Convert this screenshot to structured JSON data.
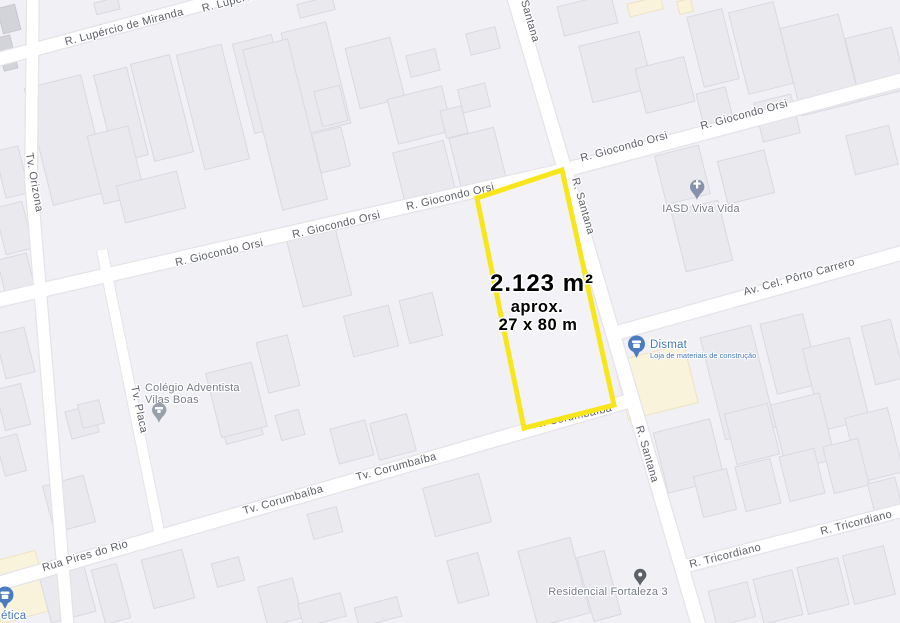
{
  "colors": {
    "background": "#f1f0f5",
    "building": "#e9e9ee",
    "building_dark": "#d3d4d9",
    "building_commercial": "#faf3dc",
    "road_fill": "#ffffff",
    "road_casing": "#e5e3e9",
    "road_label": "#5d6067",
    "poi_label_gray": "#787d87",
    "poi_label_blue": "#4578ba",
    "pin_church": "#8691ad",
    "pin_school": "#98a0ab",
    "pin_residential": "#5d6269",
    "pin_store_blue": "#4a7dc0",
    "parcel_outline": "#f7e61c",
    "parcel_text": "#000000"
  },
  "parcel": {
    "area": "2.123 m²",
    "approx": "aprox.",
    "dimensions": "27 x 80 m"
  },
  "streets": {
    "lupercio": "R. Lupércio de Miranda",
    "orizona": "Tv. Orizona",
    "giocondo": "R. Giocondo Orsi",
    "santana_short": "Santana",
    "santana": "R. Santana",
    "porto_carrero": "Av. Cel. Pôrto Carrero",
    "placa": "Tv. Placa",
    "corumbaiba": "Tv. Corumbaíba",
    "pires": "Rua Pires do Rio",
    "tricordiano": "R. Tricordiano"
  },
  "pois": {
    "iasd": {
      "name": "IASD Viva Vida"
    },
    "dismat": {
      "name": "Dismat",
      "subtitle": "Loja de materiais de construção"
    },
    "colegio": {
      "line1": "Colégio Adventista",
      "line2": "Vilas Boas"
    },
    "residencial": {
      "name": "Residencial Fortaleza 3"
    },
    "estetica": {
      "name": "ética"
    }
  }
}
